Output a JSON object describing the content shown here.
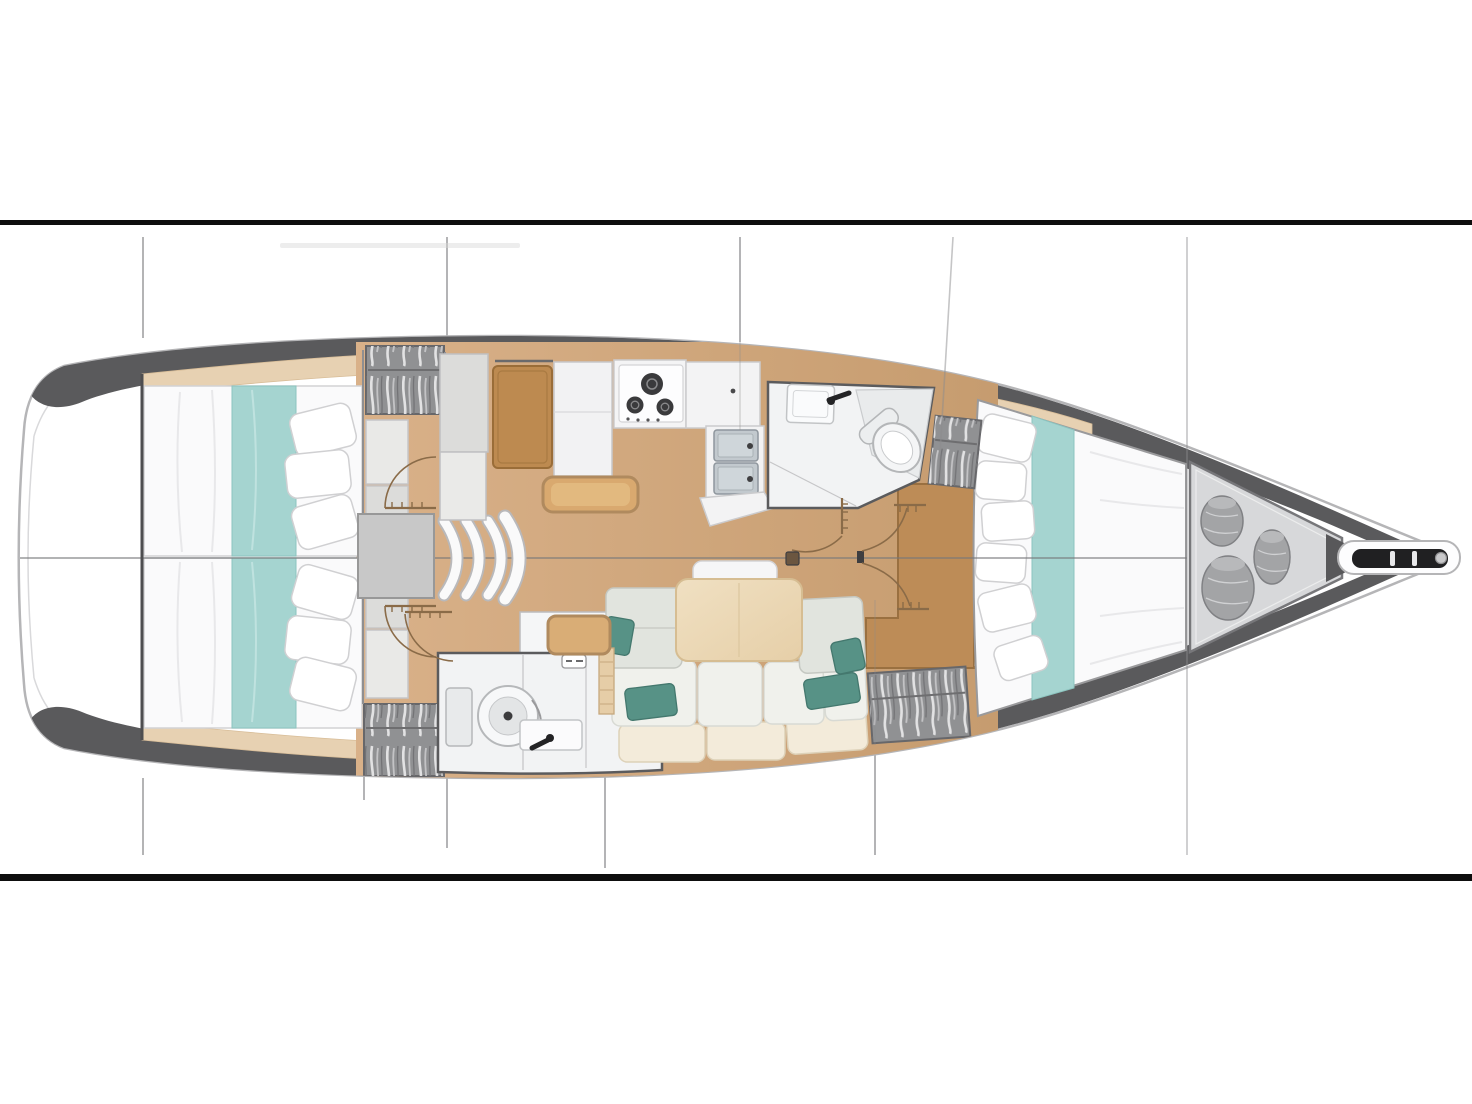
{
  "document": {
    "type": "yacht-interior-floor-plan",
    "title": "Sailing yacht interior layout plan — top-down view, bow pointing right, hull drawn between two full-width black horizontal rules",
    "view": "top-down",
    "orientation": "bow-right",
    "visible_text": "none (purely graphical drawing)"
  },
  "frame": {
    "style": "letterboxed plan: white page, thin black rule above and below the drawing",
    "rule_color": "#0e0e0e"
  },
  "counts": {
    "cabins": 3,
    "heads": 2,
    "double_berths": 3,
    "stove_burners": 3,
    "galley_sinks": 2,
    "hanging_lockers": 4,
    "bow_storage_bags": 3,
    "companionway_steps": 3,
    "teal_sofa_pillows": 4,
    "door_swing_arcs": 6
  },
  "rooms": [
    {
      "id": "aft-cabin-port",
      "name": "Aft cabin (upper left)",
      "features": [
        "double berth, white bedding",
        "teal bed runner",
        "three pillows",
        "hanging locker with clothes",
        "two storage lockers"
      ]
    },
    {
      "id": "aft-cabin-starboard",
      "name": "Aft cabin (lower left)",
      "features": [
        "double berth, white bedding",
        "teal bed runner",
        "three pillows",
        "hanging locker with clothes",
        "two storage lockers"
      ]
    },
    {
      "id": "companionway",
      "name": "Companionway",
      "features": [
        "landing platform",
        "three curved steps"
      ]
    },
    {
      "id": "nav-station",
      "name": "Navigation station",
      "features": [
        "wooden chart table",
        "navigator bench seat",
        "settee",
        "white cabinet"
      ]
    },
    {
      "id": "galley",
      "name": "Galley",
      "features": [
        "three-burner gas stove",
        "double stainless sink",
        "white counters",
        "shelf band with locker divisions"
      ]
    },
    {
      "id": "aft-head",
      "name": "Aft head (bathroom)",
      "features": [
        "marine toilet",
        "washbasin with black faucet",
        "shower partition",
        "hinged door with swing arc"
      ]
    },
    {
      "id": "salon",
      "name": "Salon",
      "features": [
        "L-shaped sofa with back cushions",
        "cream base plinth",
        "light wood dining table",
        "headrest cushion",
        "four teal throw pillows",
        "small wooden side seat",
        "fiddle-rail strip"
      ]
    },
    {
      "id": "forward-head",
      "name": "Forward head (bathroom)",
      "features": [
        "marine toilet",
        "washbasin with black faucet",
        "angled partition wall",
        "hinged door with swing arc"
      ]
    },
    {
      "id": "forward-cabin",
      "name": "Forward cabin",
      "features": [
        "V-berth double bed",
        "teal bed runner",
        "five pillows",
        "two hanging lockers with clothes",
        "wooden vanity unit",
        "double entry doors with swing arcs",
        "floor hatch"
      ]
    },
    {
      "id": "bow-storage",
      "name": "Bow storage locker",
      "features": [
        "three gray sail/fender bags",
        "dark wedge bulkhead"
      ]
    },
    {
      "id": "bow",
      "name": "Bow",
      "features": [
        "bowsprit with dark anchor-roller slot",
        "roller pins"
      ]
    }
  ],
  "drawing_marks": {
    "centerline": "thin horizontal line along hull axis",
    "section_lines": "thin vertical survey lines above and below the hull",
    "door_arcs": "brown quarter-circle swing arcs with louvered leaf combs"
  },
  "palette": {
    "page_bg": "#ffffff",
    "rule_black": "#0e0e0e",
    "hull_white": "#ffffff",
    "hull_outline": "#b5b5b7",
    "hull_inner_line": "#d9d9db",
    "gunwale_gray": "#5a5a5c",
    "shelf_wood": "#e7d1b2",
    "floor_wood_light": "#d9b189",
    "floor_wood_dark": "#c69c6f",
    "furniture_wood": "#bd8a50",
    "bench_wood": "#d9a96f",
    "table_wood": "#ecd9b9",
    "linen_white": "#fafafb",
    "runner_teal": "#a5d4d0",
    "pillow_teal": "#579286",
    "sofa_back": "#e1e4de",
    "sofa_seat": "#f0f1ec",
    "sofa_base": "#f3ebda",
    "wardrobe_gray": "#909193",
    "fixture_white": "#f2f3f4",
    "sink_steel": "#c2c9ce",
    "storage_gray": "#d7d8da",
    "bag_gray": "#a3a4a6",
    "wall_dark": "#4e4e50",
    "door_arc_brown": "#8a6b48",
    "section_line_gray": "#8b8b8d"
  },
  "icons": [
    {
      "name": "stove-burners-icon",
      "meaning": "3 gas burners"
    },
    {
      "name": "double-sink-icon",
      "meaning": "two stainless basins with drains"
    },
    {
      "name": "toilet-icon",
      "meaning": "marine toilet bowl"
    },
    {
      "name": "faucet-icon",
      "meaning": "black tap"
    },
    {
      "name": "hanging-clothes-icon",
      "meaning": "wardrobe contents"
    },
    {
      "name": "door-swing-icon",
      "meaning": "door leaf and arc"
    },
    {
      "name": "bag-icon",
      "meaning": "stowed sail/fender bag"
    },
    {
      "name": "companionway-steps-icon",
      "meaning": "curved stair treads"
    },
    {
      "name": "floor-hatch-icon",
      "meaning": "small bilge hatch"
    },
    {
      "name": "anchor-roller-icon",
      "meaning": "bowsprit slot fitting"
    }
  ]
}
